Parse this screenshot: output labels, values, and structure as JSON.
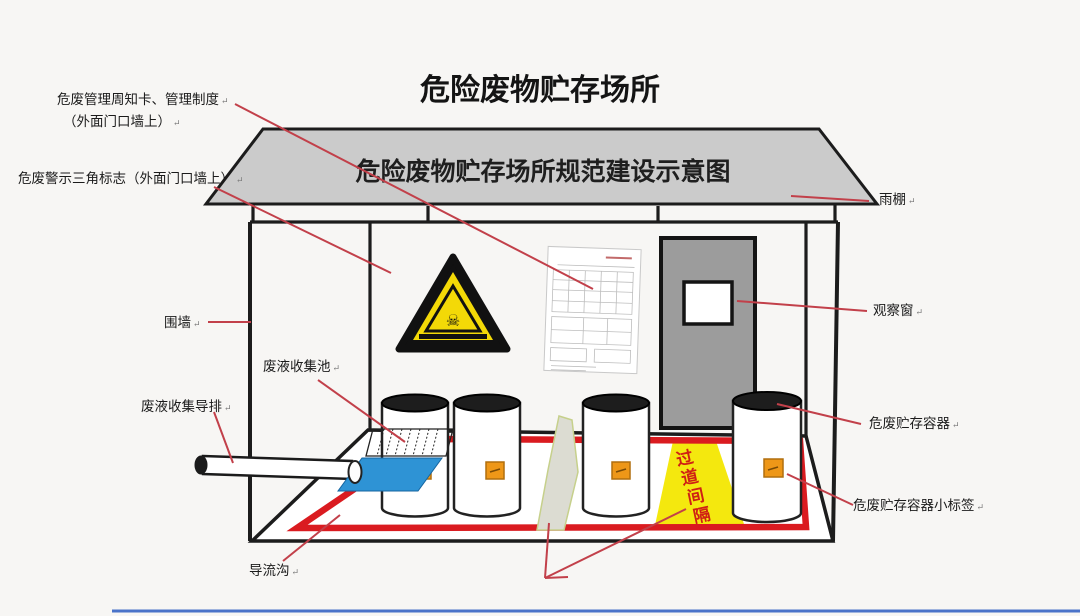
{
  "page_title": "危险废物贮存场所",
  "roof_caption": "危险废物贮存场所规范建设示意图",
  "return_mark": "↵",
  "floor_sign": {
    "char_1": "过",
    "char_2": "道",
    "char_3": "间",
    "char_4": "隔"
  },
  "callouts": {
    "notice_card_line1": "危废管理周知卡、管理制度",
    "notice_card_line2": "（外面门口墙上）",
    "warning_triangle": "危废警示三角标志（外面门口墙上）",
    "enclosure_wall": "围墙",
    "collection_pool": "废液收集池",
    "collection_drain": "废液收集导排",
    "diversion_ditch": "导流沟",
    "rain_canopy": "雨棚",
    "observation_window": "观察窗",
    "storage_container": "危废贮存容器",
    "container_label": "危废贮存容器小标签"
  },
  "colors": {
    "leader_red": "#c2404a",
    "ditch_red": "#da1b20",
    "pool_blue": "#2e93d5",
    "sign_yellow": "#f4e80e",
    "label_orange": "#ee9718",
    "roof_gray": "#cbcbcb",
    "door_gray": "#9c9c9c",
    "bottom_rule_blue": "#4a73c9"
  }
}
